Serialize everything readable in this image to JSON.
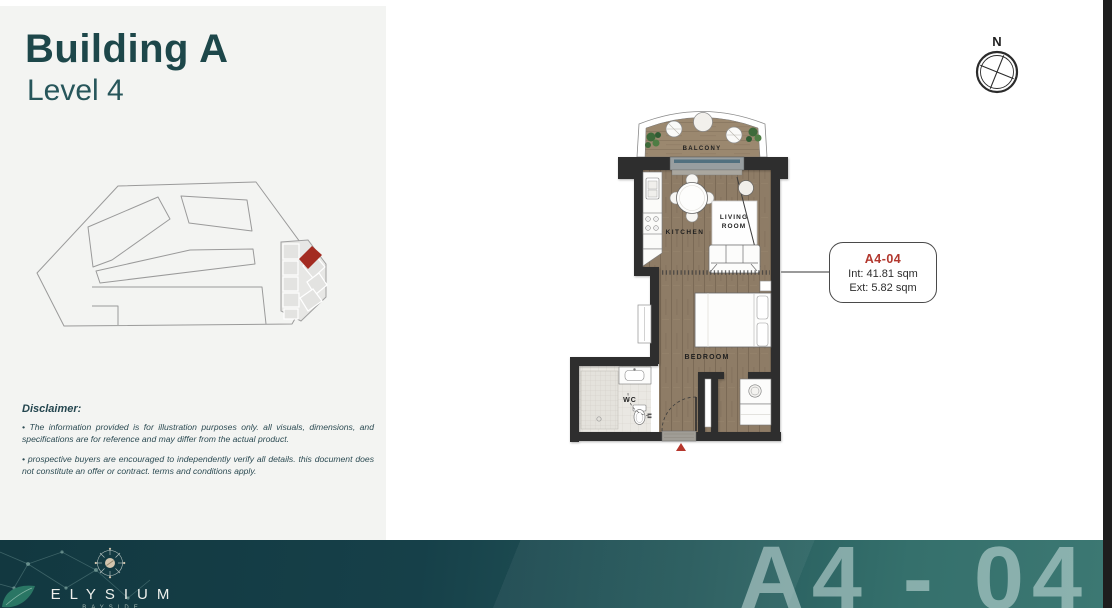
{
  "header": {
    "title": "Building A",
    "subtitle": "Level 4"
  },
  "disclaimer": {
    "heading": "Disclaimer:",
    "bullet1": "• The information provided is for illustration purposes only. all visuals, dimensions, and specifications are for reference and may differ from the actual product.",
    "bullet2": "• prospective buyers are encouraged to independently verify all details. this document does not constitute an offer or contract. terms and conditions apply."
  },
  "compass": {
    "north_label": "N"
  },
  "floor_plan": {
    "rooms": {
      "balcony": "BALCONY",
      "kitchen": "KITCHEN",
      "living_room_line1": "LIVING",
      "living_room_line2": "ROOM",
      "bedroom": "BEDROOM",
      "wc": "WC"
    }
  },
  "unit_card": {
    "unit_number": "A4-04",
    "interior_area": "Int: 41.81 sqm",
    "exterior_area": "Ext: 5.82 sqm"
  },
  "footer": {
    "brand_name": "ELYSIUM",
    "brand_tagline": "BAYSIDE",
    "unit_code_display": "A4 - 04"
  },
  "colors": {
    "accent_red": "#b2382e",
    "title_teal": "#1d474a",
    "highlight_unit_red": "#a32b21",
    "banner_dark": "#123840",
    "banner_light": "#3c7873",
    "wall_black": "#2d2d2d"
  }
}
